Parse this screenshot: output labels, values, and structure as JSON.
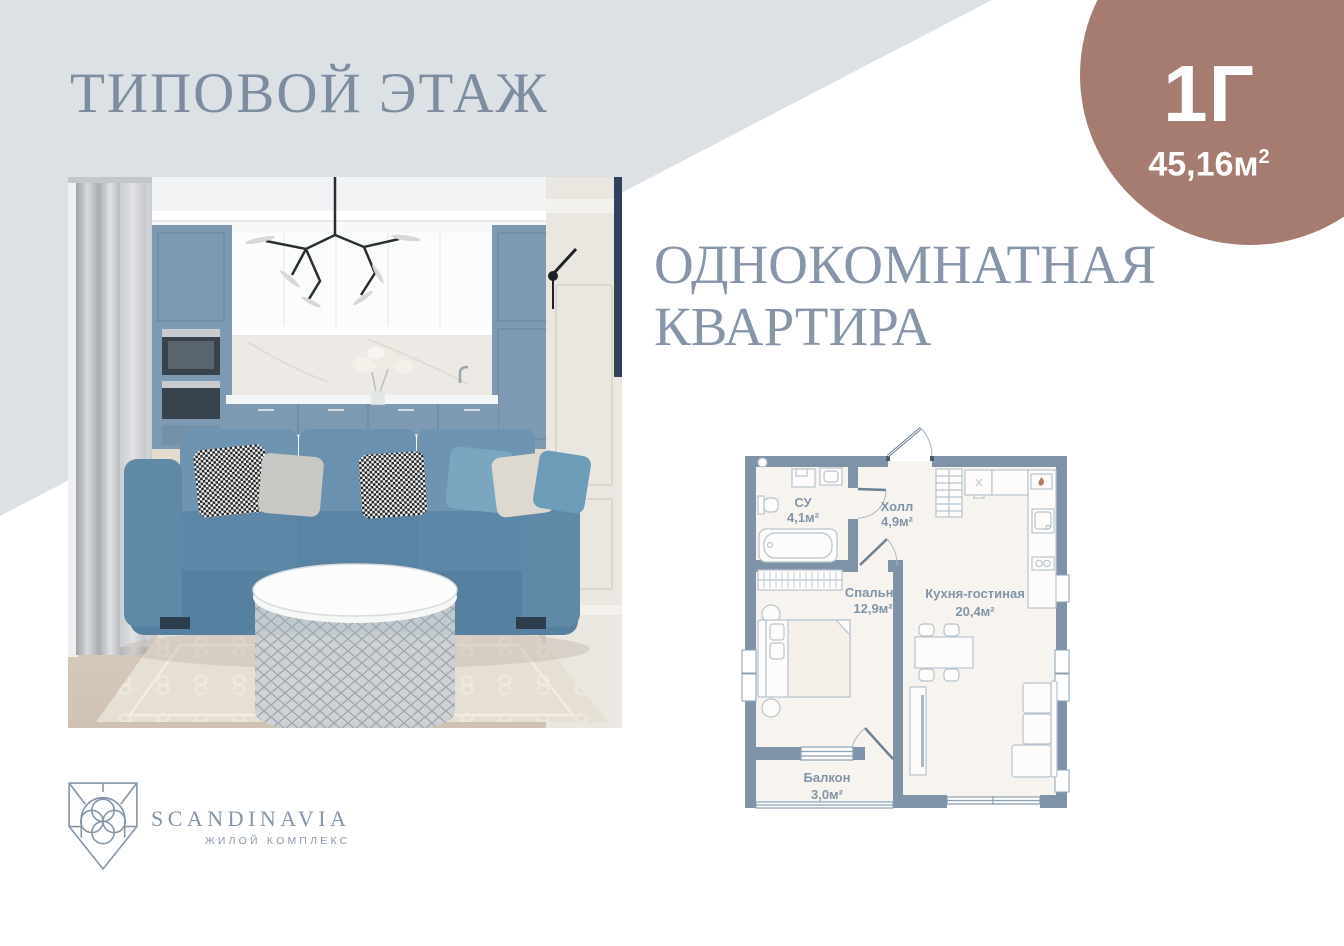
{
  "header": {
    "title": "ТИПОВОЙ ЭТАЖ"
  },
  "badge": {
    "unit": "1Г",
    "area": "45,16м",
    "area_sup": "2",
    "color": "#a67c71"
  },
  "apartment": {
    "heading_line1": "ОДНОКОМНАТНАЯ",
    "heading_line2": "КВАРТИРА"
  },
  "floorplan": {
    "rooms": [
      {
        "name": "СУ",
        "area": "4,1м²"
      },
      {
        "name": "Холл",
        "area": "4,9м²"
      },
      {
        "name": "Спальня",
        "area": "12,9м²"
      },
      {
        "name": "Кухня-гостиная",
        "area": "20,4м²"
      },
      {
        "name": "Балкон",
        "area": "3,0м²"
      }
    ],
    "colors": {
      "wall": "#7e93a8",
      "floor": "#f7f3ee",
      "label": "#8095a9"
    }
  },
  "logo": {
    "name": "SCANDINAVIA",
    "subtitle": "ЖИЛОЙ КОМПЛЕКС"
  },
  "colors": {
    "background": "#ffffff",
    "diagonal_band": "#dce1e6",
    "title": "#7d8c9f",
    "heading": "#8695a8",
    "badge": "#a67c71",
    "logo": "#8495a8"
  }
}
